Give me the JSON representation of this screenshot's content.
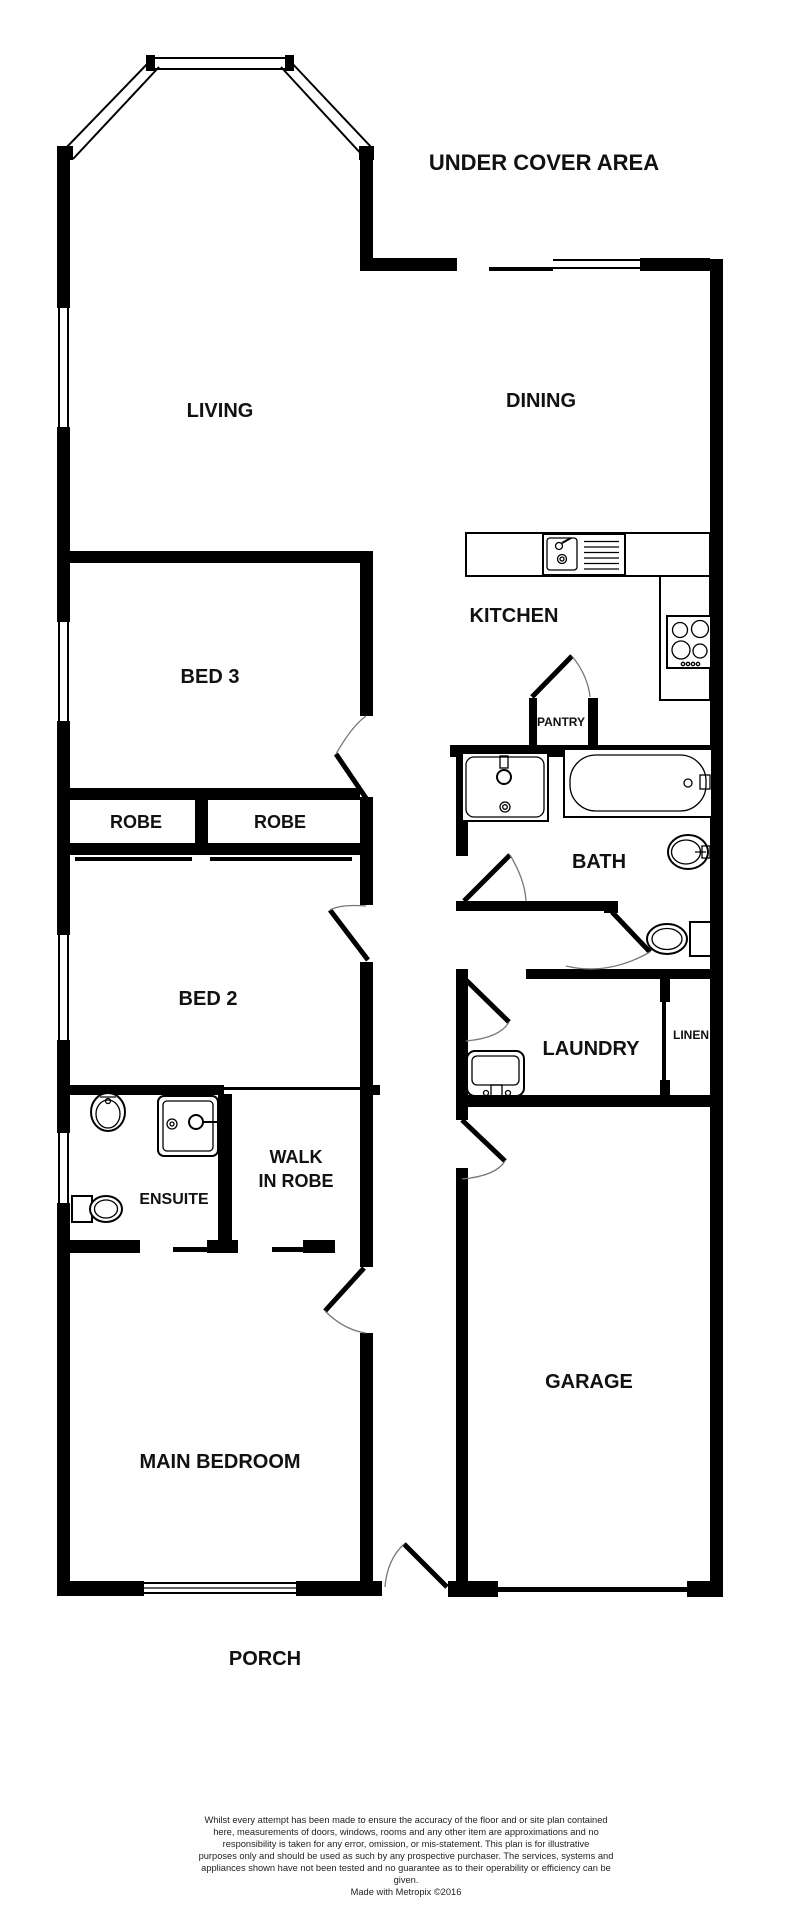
{
  "plan": {
    "labels": {
      "under_cover_area": "UNDER COVER AREA",
      "living": "LIVING",
      "dining": "DINING",
      "bed3": "BED 3",
      "kitchen": "KITCHEN",
      "pantry": "PANTRY",
      "robe_left": "ROBE",
      "robe_right": "ROBE",
      "bath": "BATH",
      "bed2": "BED 2",
      "laundry": "LAUNDRY",
      "linen": "LINEN",
      "ensuite": "ENSUITE",
      "walk_in_robe_line1": "WALK",
      "walk_in_robe_line2": "IN ROBE",
      "main_bedroom": "MAIN BEDROOM",
      "garage": "GARAGE",
      "porch": "PORCH"
    },
    "colors": {
      "wall": "#000000",
      "background": "#ffffff",
      "text": "#111111"
    },
    "disclaimer": {
      "line1": "Whilst every attempt has been made to ensure the accuracy of the floor and or site plan contained",
      "line2": "here, measurements of doors, windows, rooms and any other item are approximations and no",
      "line3": "responsibility is taken for any error, omission, or mis-statement. This plan is for illustrative",
      "line4": "purposes only and should be used as such by any prospective purchaser. The services, systems and",
      "line5": "appliances shown have not been tested and no guarantee as to their operability or efficiency can be",
      "line6": "given.",
      "credit": "Made with Metropix ©2016"
    }
  }
}
